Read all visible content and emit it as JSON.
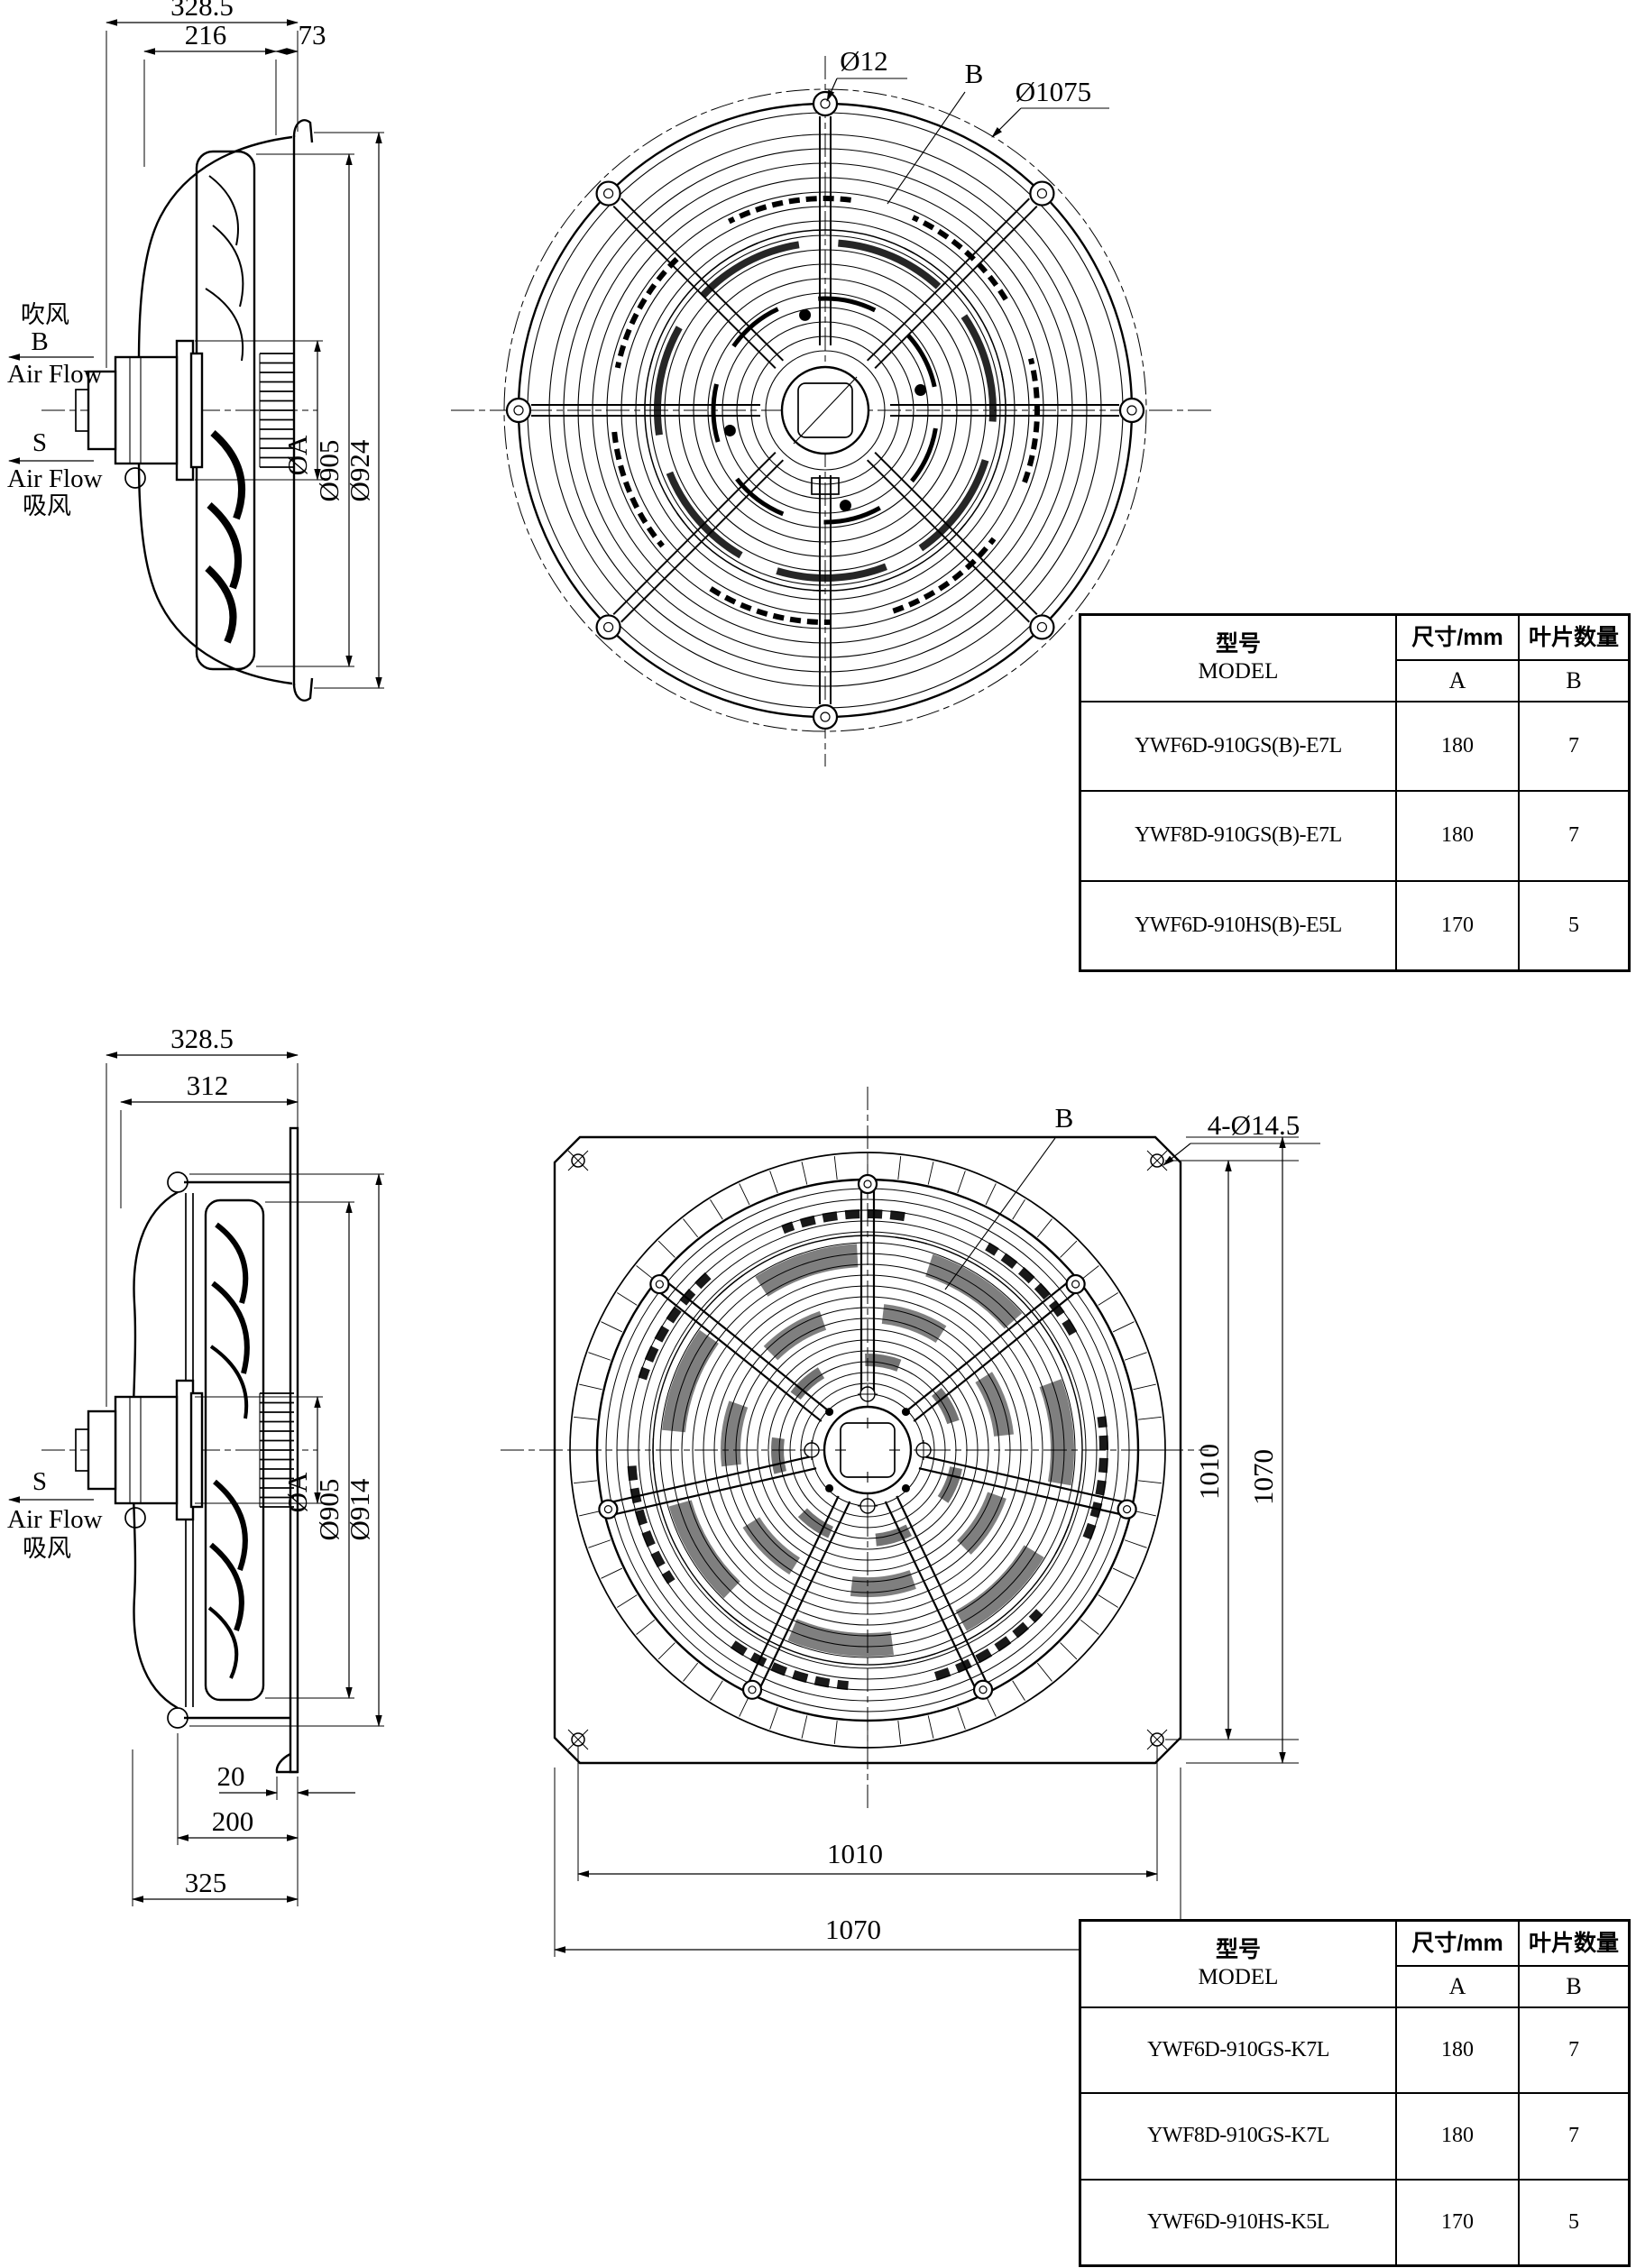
{
  "top_view": {
    "side": {
      "dim_total": "328.5",
      "dim_bell": "216",
      "dim_lip": "73",
      "dim_hub": "ØA",
      "dim_impeller": "Ø905",
      "dim_ring": "Ø924",
      "blow_cn": "吹风",
      "blow_code": "B",
      "blow_en": "Air Flow",
      "suck_code": "S",
      "suck_en": "Air Flow",
      "suck_cn": "吸风"
    },
    "front": {
      "wire_dia": "Ø12",
      "guard_dia": "Ø1075",
      "blade_ref": "B"
    }
  },
  "bottom_view": {
    "side": {
      "dim_total": "328.5",
      "dim_bell": "312",
      "dim_hub": "ØA",
      "dim_impeller": "Ø905",
      "dim_ring": "Ø914",
      "dim_lip": "20",
      "dim_throat": "200",
      "dim_flange": "325",
      "suck_code": "S",
      "suck_en": "Air Flow",
      "suck_cn": "吸风"
    },
    "front": {
      "blade_ref": "B",
      "hole_note": "4-Ø14.5",
      "pitch_v": "1010",
      "plate_v": "1070",
      "pitch_h": "1010",
      "plate_h": "1070"
    }
  },
  "table_header": {
    "model_cn": "型号",
    "model_en": "MODEL",
    "size": "尺寸/mm",
    "qty": "叶片数量",
    "col_a": "A",
    "col_b": "B"
  },
  "table_top": {
    "rows": [
      {
        "model": "YWF6D-910GS(B)-E7L",
        "a": "180",
        "b": "7"
      },
      {
        "model": "YWF8D-910GS(B)-E7L",
        "a": "180",
        "b": "7"
      },
      {
        "model": "YWF6D-910HS(B)-E5L",
        "a": "170",
        "b": "5"
      }
    ]
  },
  "table_bottom": {
    "rows": [
      {
        "model": "YWF6D-910GS-K7L",
        "a": "180",
        "b": "7"
      },
      {
        "model": "YWF8D-910GS-K7L",
        "a": "180",
        "b": "7"
      },
      {
        "model": "YWF6D-910HS-K5L",
        "a": "170",
        "b": "5"
      }
    ]
  }
}
